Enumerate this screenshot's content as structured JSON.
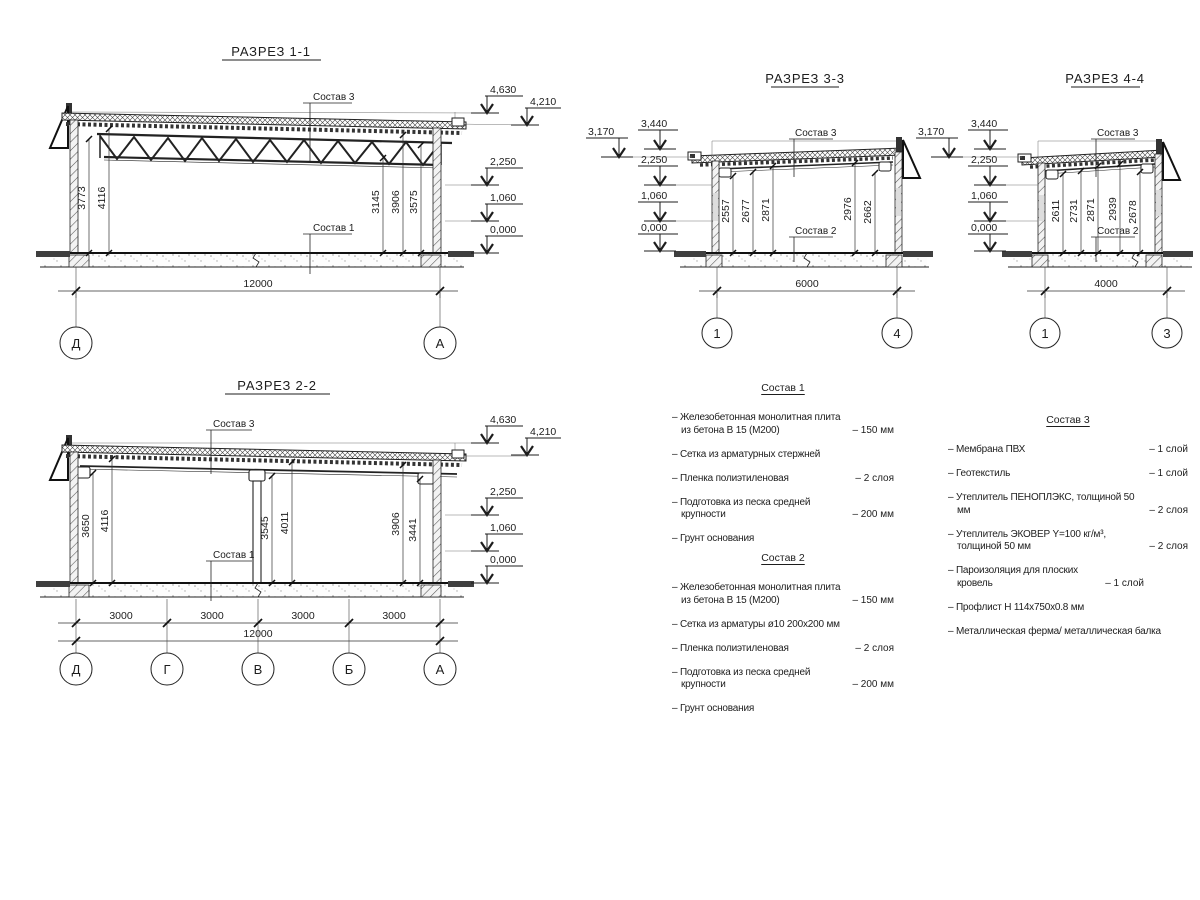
{
  "s11": {
    "title": "РАЗРЕЗ 1-1",
    "sostav_top": "Состав 3",
    "sostav_bottom": "Состав 1",
    "d1": "3773",
    "d2": "4116",
    "d3": "3145",
    "d4": "3906",
    "d5": "3575",
    "total": "12000",
    "gl": "Д",
    "gr": "А",
    "e1": "4,630",
    "e2": "4,210",
    "e3": "2,250",
    "e4": "1,060",
    "e5": "0,000"
  },
  "s22": {
    "title": "РАЗРЕЗ 2-2",
    "sostav_top": "Состав 3",
    "sostav_bottom": "Состав 1",
    "d1": "3650",
    "d2": "4116",
    "d3": "3545",
    "d4": "4011",
    "d5": "3906",
    "d6": "3441",
    "spans": [
      "3000",
      "3000",
      "3000",
      "3000"
    ],
    "total": "12000",
    "g1": "Д",
    "g2": "Г",
    "g3": "В",
    "g4": "Б",
    "g5": "А",
    "e1": "4,630",
    "e2": "4,210",
    "e3": "2,250",
    "e4": "1,060",
    "e5": "0,000"
  },
  "s33": {
    "title": "РАЗРЕЗ 3-3",
    "sostav_top": "Состав 3",
    "sostav_bottom": "Состав 2",
    "d1": "2557",
    "d2": "2677",
    "d3": "2871",
    "d4": "2976",
    "d5": "2662",
    "total": "6000",
    "gl": "1",
    "gr": "4",
    "e1": "3,170",
    "e2": "3,440",
    "e3": "2,250",
    "e4": "1,060",
    "e5": "0,000"
  },
  "s44": {
    "title": "РАЗРЕЗ 4-4",
    "sostav_top": "Состав 3",
    "sostav_bottom": "Состав 2",
    "d1": "2611",
    "d2": "2731",
    "d3": "2871",
    "d4": "2939",
    "d5": "2678",
    "total": "4000",
    "gl": "1",
    "gr": "3",
    "e1": "3,170",
    "e2": "3,440",
    "e3": "2,250",
    "e4": "1,060",
    "e5": "0,000"
  },
  "lists": {
    "sostav1": {
      "title": "Состав 1",
      "items": [
        {
          "t": "– Железобетонная  монолитная плита из бетона В 15 (М200)",
          "v": "– 150 мм"
        },
        {
          "t": "– Сетка из арматурных стержней",
          "v": ""
        },
        {
          "t": "– Пленка полиэтиленовая",
          "v": "– 2 слоя"
        },
        {
          "t": "– Подготовка из песка средней крупности",
          "v": "– 200 мм"
        },
        {
          "t": "– Грунт основания",
          "v": ""
        }
      ]
    },
    "sostav2": {
      "title": "Состав 2",
      "items": [
        {
          "t": "– Железобетонная  монолитная плита из бетона В 15 (М200)",
          "v": "– 150 мм"
        },
        {
          "t": "– Сетка из арматуры ø10 200х200 мм",
          "v": ""
        },
        {
          "t": "– Пленка полиэтиленовая",
          "v": "– 2 слоя"
        },
        {
          "t": "– Подготовка из песка средней крупности",
          "v": "– 200 мм"
        },
        {
          "t": "– Грунт основания",
          "v": ""
        }
      ]
    },
    "sostav3": {
      "title": "Состав 3",
      "items": [
        {
          "t": "– Мембрана ПВХ",
          "v": "– 1 слой"
        },
        {
          "t": "– Геотекстиль",
          "v": "– 1 слой"
        },
        {
          "t": "– Утеплитель ПЕНОПЛЭКС, толщиной 50 мм",
          "v": "– 2 слоя"
        },
        {
          "t": "– Утеплитель ЭКОВЕР Y=100 кг/м³, толщиной 50 мм",
          "v": "– 2 слоя"
        },
        {
          "t": "– Пароизоляция для плоских кровель",
          "v": "– 1 слой"
        },
        {
          "t": "– Профлист Н 114х750х0.8 мм",
          "v": ""
        },
        {
          "t": "– Металлическая ферма/ металлическая балка",
          "v": ""
        }
      ]
    }
  }
}
